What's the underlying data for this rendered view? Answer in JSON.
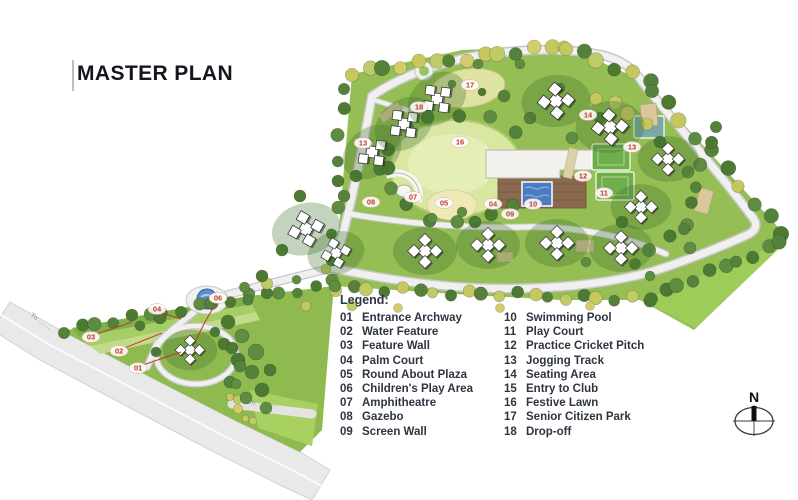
{
  "title": "MASTER PLAN",
  "legend": {
    "heading": "Legend:",
    "items": [
      {
        "num": "01",
        "label": "Entrance Archway"
      },
      {
        "num": "02",
        "label": "Water Feature"
      },
      {
        "num": "03",
        "label": "Feature Wall"
      },
      {
        "num": "04",
        "label": "Palm Court"
      },
      {
        "num": "05",
        "label": "Round About Plaza"
      },
      {
        "num": "06",
        "label": "Children's Play Area"
      },
      {
        "num": "07",
        "label": "Amphitheatre"
      },
      {
        "num": "08",
        "label": "Gazebo"
      },
      {
        "num": "09",
        "label": "Screen Wall"
      },
      {
        "num": "10",
        "label": "Swimming Pool"
      },
      {
        "num": "11",
        "label": "Play Court"
      },
      {
        "num": "12",
        "label": "Practice Cricket Pitch"
      },
      {
        "num": "13",
        "label": "Jogging Track"
      },
      {
        "num": "14",
        "label": "Seating Area"
      },
      {
        "num": "15",
        "label": "Entry to Club"
      },
      {
        "num": "16",
        "label": "Festive Lawn"
      },
      {
        "num": "17",
        "label": "Senior Citizen Park"
      },
      {
        "num": "18",
        "label": "Drop-off"
      }
    ]
  },
  "compass": {
    "label": "N"
  },
  "map": {
    "marker_color": "#c0392b",
    "labels": [
      {
        "num": "01",
        "x": 138,
        "y": 368
      },
      {
        "num": "02",
        "x": 119,
        "y": 351
      },
      {
        "num": "03",
        "x": 91,
        "y": 337
      },
      {
        "num": "04",
        "x": 157,
        "y": 309
      },
      {
        "num": "06",
        "x": 218,
        "y": 298
      },
      {
        "num": "08",
        "x": 371,
        "y": 202
      },
      {
        "num": "07",
        "x": 413,
        "y": 197
      },
      {
        "num": "05",
        "x": 444,
        "y": 203
      },
      {
        "num": "04",
        "x": 493,
        "y": 204
      },
      {
        "num": "09",
        "x": 510,
        "y": 214
      },
      {
        "num": "10",
        "x": 533,
        "y": 204
      },
      {
        "num": "13",
        "x": 363,
        "y": 143
      },
      {
        "num": "18",
        "x": 419,
        "y": 107
      },
      {
        "num": "17",
        "x": 470,
        "y": 85
      },
      {
        "num": "16",
        "x": 460,
        "y": 142
      },
      {
        "num": "14",
        "x": 588,
        "y": 115
      },
      {
        "num": "13",
        "x": 632,
        "y": 147
      },
      {
        "num": "12",
        "x": 583,
        "y": 176
      },
      {
        "num": "11",
        "x": 604,
        "y": 193
      }
    ],
    "road_labels": [
      {
        "text": "To ......",
        "x": 30,
        "y": 316,
        "rot": 35
      },
      {
        "text": "To ........",
        "x": 248,
        "y": 404,
        "rot": 4
      }
    ]
  }
}
